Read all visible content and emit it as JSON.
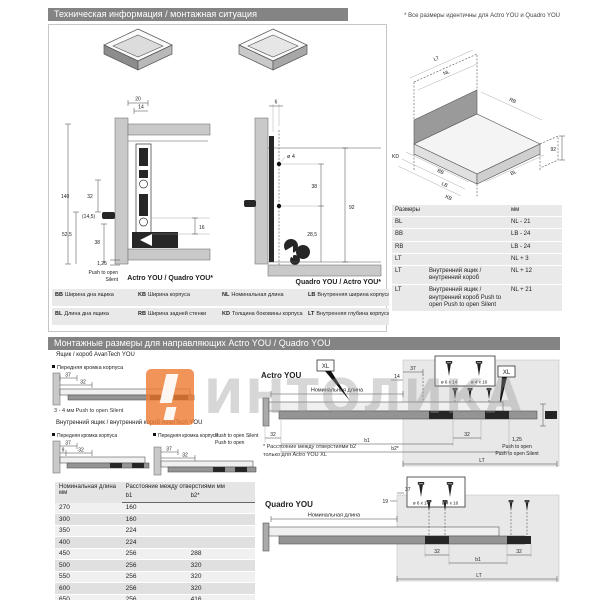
{
  "watermark": {
    "text": "ИНТОЛИКА"
  },
  "top": {
    "title": "Техническая информация / монтажная ситуация",
    "note": "* Все размеры идентичны для Actro YOU и Quadro YOU",
    "section1": {
      "caption": "Actro YOU / Quadro YOU*",
      "d20": "20",
      "d14": "14",
      "d140": "140",
      "d32": "32",
      "d14_5": "(14,5)",
      "d52_5": "52,5",
      "d38": "38",
      "d16": "16",
      "d1_25": "1,25",
      "push_line1": "Push to open",
      "push_line2": "Silent"
    },
    "section2": {
      "caption": "Quadro YOU / Actro YOU*",
      "d6": "6",
      "dia4": "ø 4",
      "d38": "38",
      "d92": "92",
      "d28_5": "28,5"
    },
    "iso": {
      "lt": "LT",
      "nl": "NL",
      "rb": "RB",
      "d92": "92",
      "kd": "KD",
      "bb": "BB",
      "lb": "LB",
      "kb": "KB",
      "bl": "BL"
    },
    "dim_table": {
      "col_dim": "Размеры",
      "col_mm": "мм",
      "rows": [
        {
          "dim": "BL",
          "desc": "",
          "value": "NL - 21"
        },
        {
          "dim": "BB",
          "desc": "",
          "value": "LB - 24"
        },
        {
          "dim": "RB",
          "desc": "",
          "value": "LB - 24"
        },
        {
          "dim": "LT",
          "desc": "",
          "value": "NL + 3"
        },
        {
          "dim": "LT",
          "desc": "Внутренний ящик / внутренний короб",
          "value": "NL + 12"
        },
        {
          "dim": "LT",
          "desc": "Внутренний ящик / внутренний короб Push to open Push to open Silent",
          "value": "NL + 21"
        }
      ]
    },
    "legend": {
      "items": [
        {
          "code": "BB",
          "label": "Ширина дна ящика"
        },
        {
          "code": "KB",
          "label": "Ширина корпуса"
        },
        {
          "code": "NL",
          "label": "Номинальная длина"
        },
        {
          "code": "LB",
          "label": "Внутренняя ширина корпуса"
        },
        {
          "code": "BL",
          "label": "Длина дна ящика"
        },
        {
          "code": "RB",
          "label": "Ширина задней стенки"
        },
        {
          "code": "KD",
          "label": "Толщина боковины корпуса"
        },
        {
          "code": "LT",
          "label": "Внутренняя глубина корпуса"
        }
      ]
    }
  },
  "bottom": {
    "title": "Монтажные размеры для направляющих Actro YOU / Quadro YOU",
    "avantech_label": "Ящик / короб AvanTech YOU",
    "inner_avantech_label": "Внутренний ящик / внутренний короб AvanTech YOU",
    "front_edge": "Передняя кромка корпуса",
    "push_silent": "Push to open Silent",
    "push_open": "Push to open",
    "gap_note": "3 - 4 мм Push to open Silent",
    "d37": "37",
    "d32": "32",
    "d9": "9",
    "d14": "14",
    "d19": "19",
    "d38": "38",
    "d1_25": "1,25",
    "b1": "b1",
    "b2": "b2*",
    "lt": "LT",
    "actro_label": "Actro YOU",
    "quadro_label": "Quadro YOU",
    "nominal_length": "Номинальная длина",
    "xl": "XL",
    "screw1": "ø 6 x 14",
    "screw2": "ø 4 x 16",
    "note_line1": "* Расстояние между отверстиями b2",
    "note_line2": "только для Actro YOU XL",
    "hole_table": {
      "h_nominal": "Номинальная длина",
      "h_mm": "мм",
      "h_dist": "Расстояние между отверстиями мм",
      "h_b1": "b1",
      "h_b2": "b2*",
      "rows": [
        {
          "nl": "270",
          "b1": "160",
          "b2": ""
        },
        {
          "nl": "300",
          "b1": "160",
          "b2": ""
        },
        {
          "nl": "350",
          "b1": "224",
          "b2": ""
        },
        {
          "nl": "400",
          "b1": "224",
          "b2": ""
        },
        {
          "nl": "450",
          "b1": "256",
          "b2": "288"
        },
        {
          "nl": "500",
          "b1": "256",
          "b2": "320"
        },
        {
          "nl": "550",
          "b1": "256",
          "b2": "320"
        },
        {
          "nl": "600",
          "b1": "256",
          "b2": "320"
        },
        {
          "nl": "650",
          "b1": "256",
          "b2": "416"
        }
      ]
    }
  }
}
